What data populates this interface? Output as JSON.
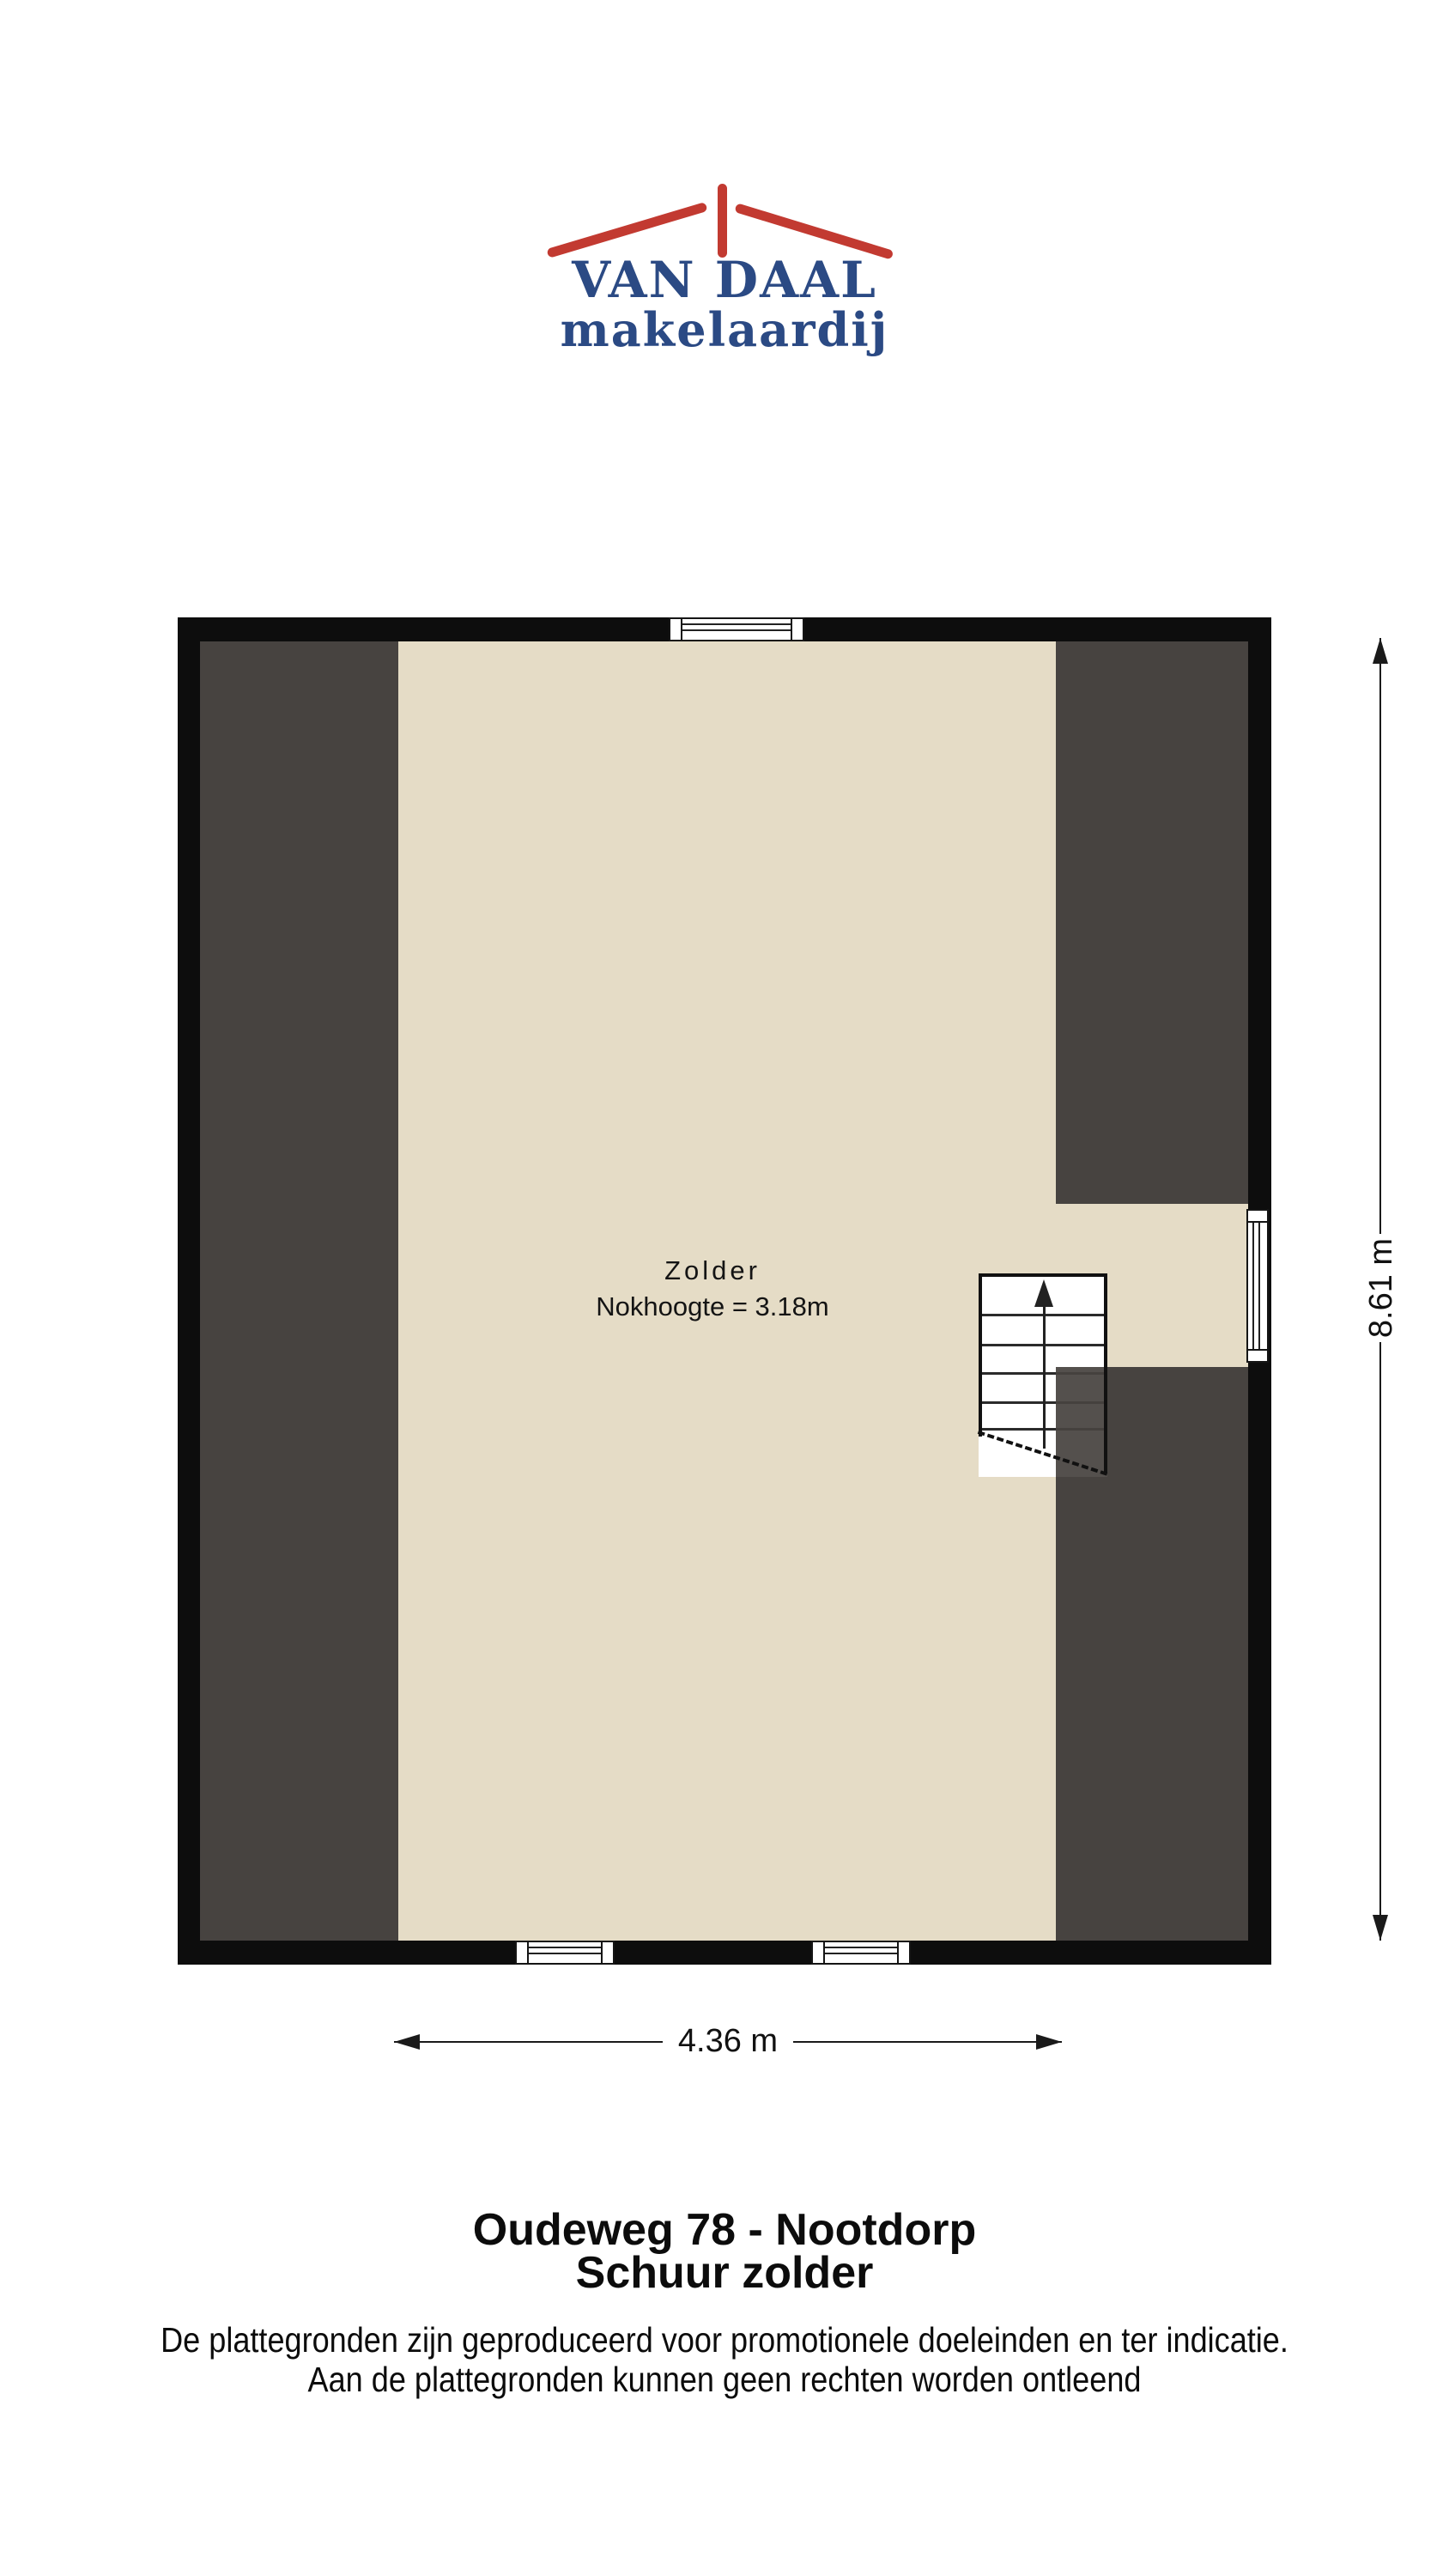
{
  "logo": {
    "title": "VAN DAAL",
    "subtitle": "makelaardij",
    "brand_blue": "#2b4a84",
    "brand_red": "#c23a31"
  },
  "floor_plan": {
    "room_label": "Zolder",
    "room_sublabel": "Nokhoogte = 3.18m",
    "height_dimension": "8.61 m",
    "width_dimension": "4.36 m",
    "colors": {
      "floor": "#e5dcc6",
      "roof_slope": "#474340",
      "wall": "#0d0d0d"
    }
  },
  "footer": {
    "title_line1": "Oudeweg 78 - Nootdorp",
    "title_line2": "Schuur zolder",
    "disclaimer_line1": "De plattegronden zijn geproduceerd voor promotionele doeleinden en ter indicatie.",
    "disclaimer_line2": "Aan de plattegronden kunnen geen rechten worden ontleend"
  }
}
